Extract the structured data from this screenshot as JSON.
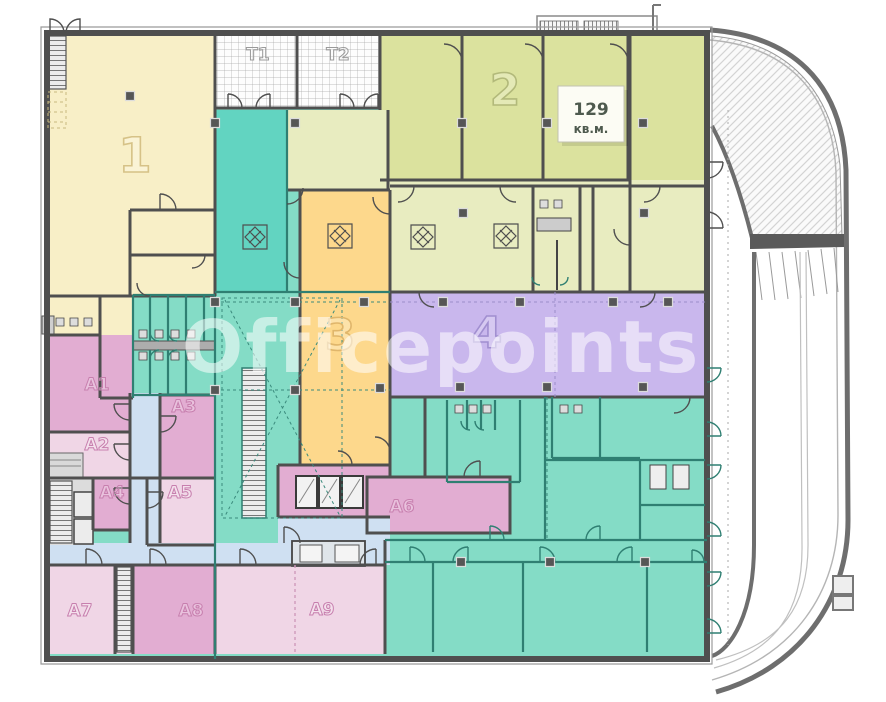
{
  "watermark": "Officepoints",
  "area_badge": {
    "value": "129",
    "unit": "кв.м."
  },
  "zones": {
    "zone1": "1",
    "zone2": "2",
    "zone3": "3",
    "zone4": "4",
    "t1": "T1",
    "t2": "T2",
    "a1": "A1",
    "a2": "A2",
    "a3": "A3",
    "a4": "A4",
    "a5": "A5",
    "a6": "A6",
    "a7": "A7",
    "a8": "A8",
    "a9": "A9"
  },
  "colors": {
    "cream": "#f8efc7",
    "olive": "#dbe29e",
    "olive_light": "#e8ecc0",
    "teal": "#84dcc6",
    "teal_bright": "#62d4c1",
    "orange": "#fdd88c",
    "purple": "#c9b7ed",
    "pink": "#e2add2",
    "pink_light": "#f0d6e6",
    "blue_corridor": "#cfe0f2",
    "core_gray": "#dcdcdc",
    "wall_gray": "#4f4f4f",
    "wall_teal": "#2f7f72",
    "watermark_fill": "rgba(255,255,255,0.55)",
    "badge_text": "#4e5a4e",
    "label_pink": "#c77fae",
    "label_cream": "#d6c287",
    "label_olive": "#b2b97a",
    "label_orange": "#e0b66b",
    "label_purple": "#a18fd0",
    "label_gray": "#9a9a9a"
  }
}
